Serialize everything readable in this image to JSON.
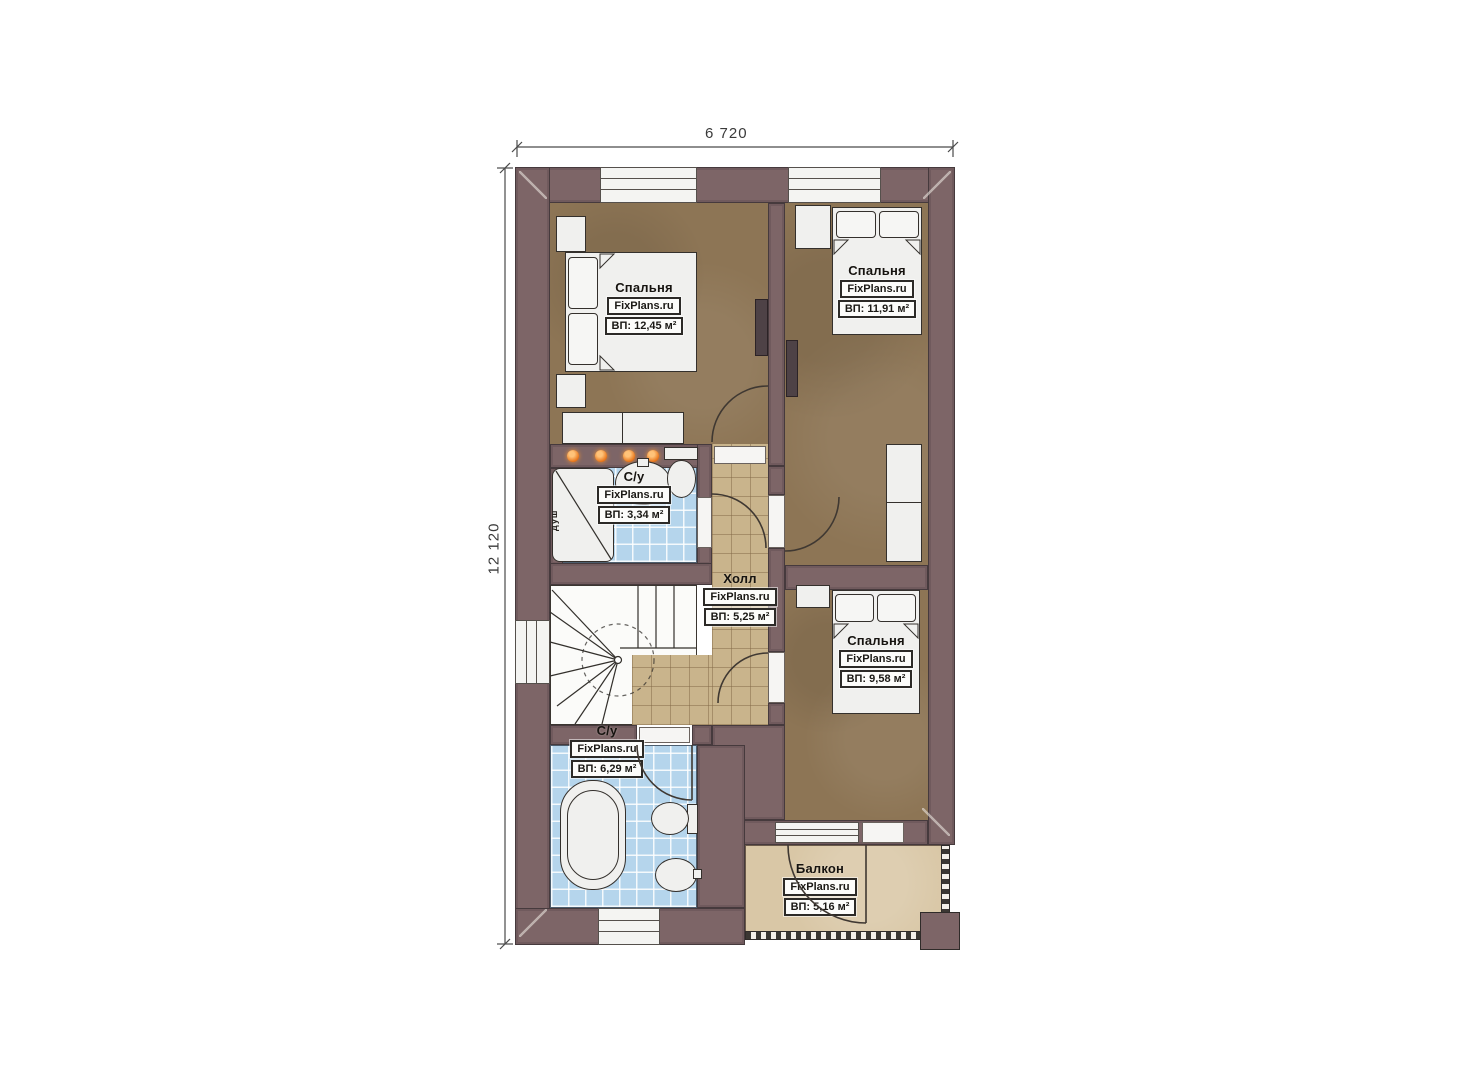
{
  "plan": {
    "brand": "FixPlans.ru",
    "dimensions": {
      "width": "6 720",
      "height": "12 120"
    },
    "rooms": [
      {
        "key": "bedroom-1",
        "name": "Спальня",
        "area": "ВП: 12,45 м²"
      },
      {
        "key": "bedroom-2",
        "name": "Спальня",
        "area": "ВП: 11,91 м²"
      },
      {
        "key": "bathroom-small",
        "name": "С/у",
        "area": "ВП: 3,34 м²"
      },
      {
        "key": "hall",
        "name": "Холл",
        "area": "ВП: 5,25 м²"
      },
      {
        "key": "bedroom-3",
        "name": "Спальня",
        "area": "ВП: 9,58 м²"
      },
      {
        "key": "bathroom-main",
        "name": "С/у",
        "area": "ВП: 6,29 м²"
      },
      {
        "key": "balcony",
        "name": "Балкон",
        "area": "ВП: 5,16 м²"
      }
    ],
    "fixture_labels": {
      "shower": "душ"
    },
    "colors": {
      "wall": "#7d6567",
      "bedroom_floor": "#8d7555",
      "hall_floor": "#c9b48c",
      "bath_floor": "#b5d5ec",
      "balcony_floor": "#d9c7a6",
      "spotlight": "#e8761b"
    }
  }
}
